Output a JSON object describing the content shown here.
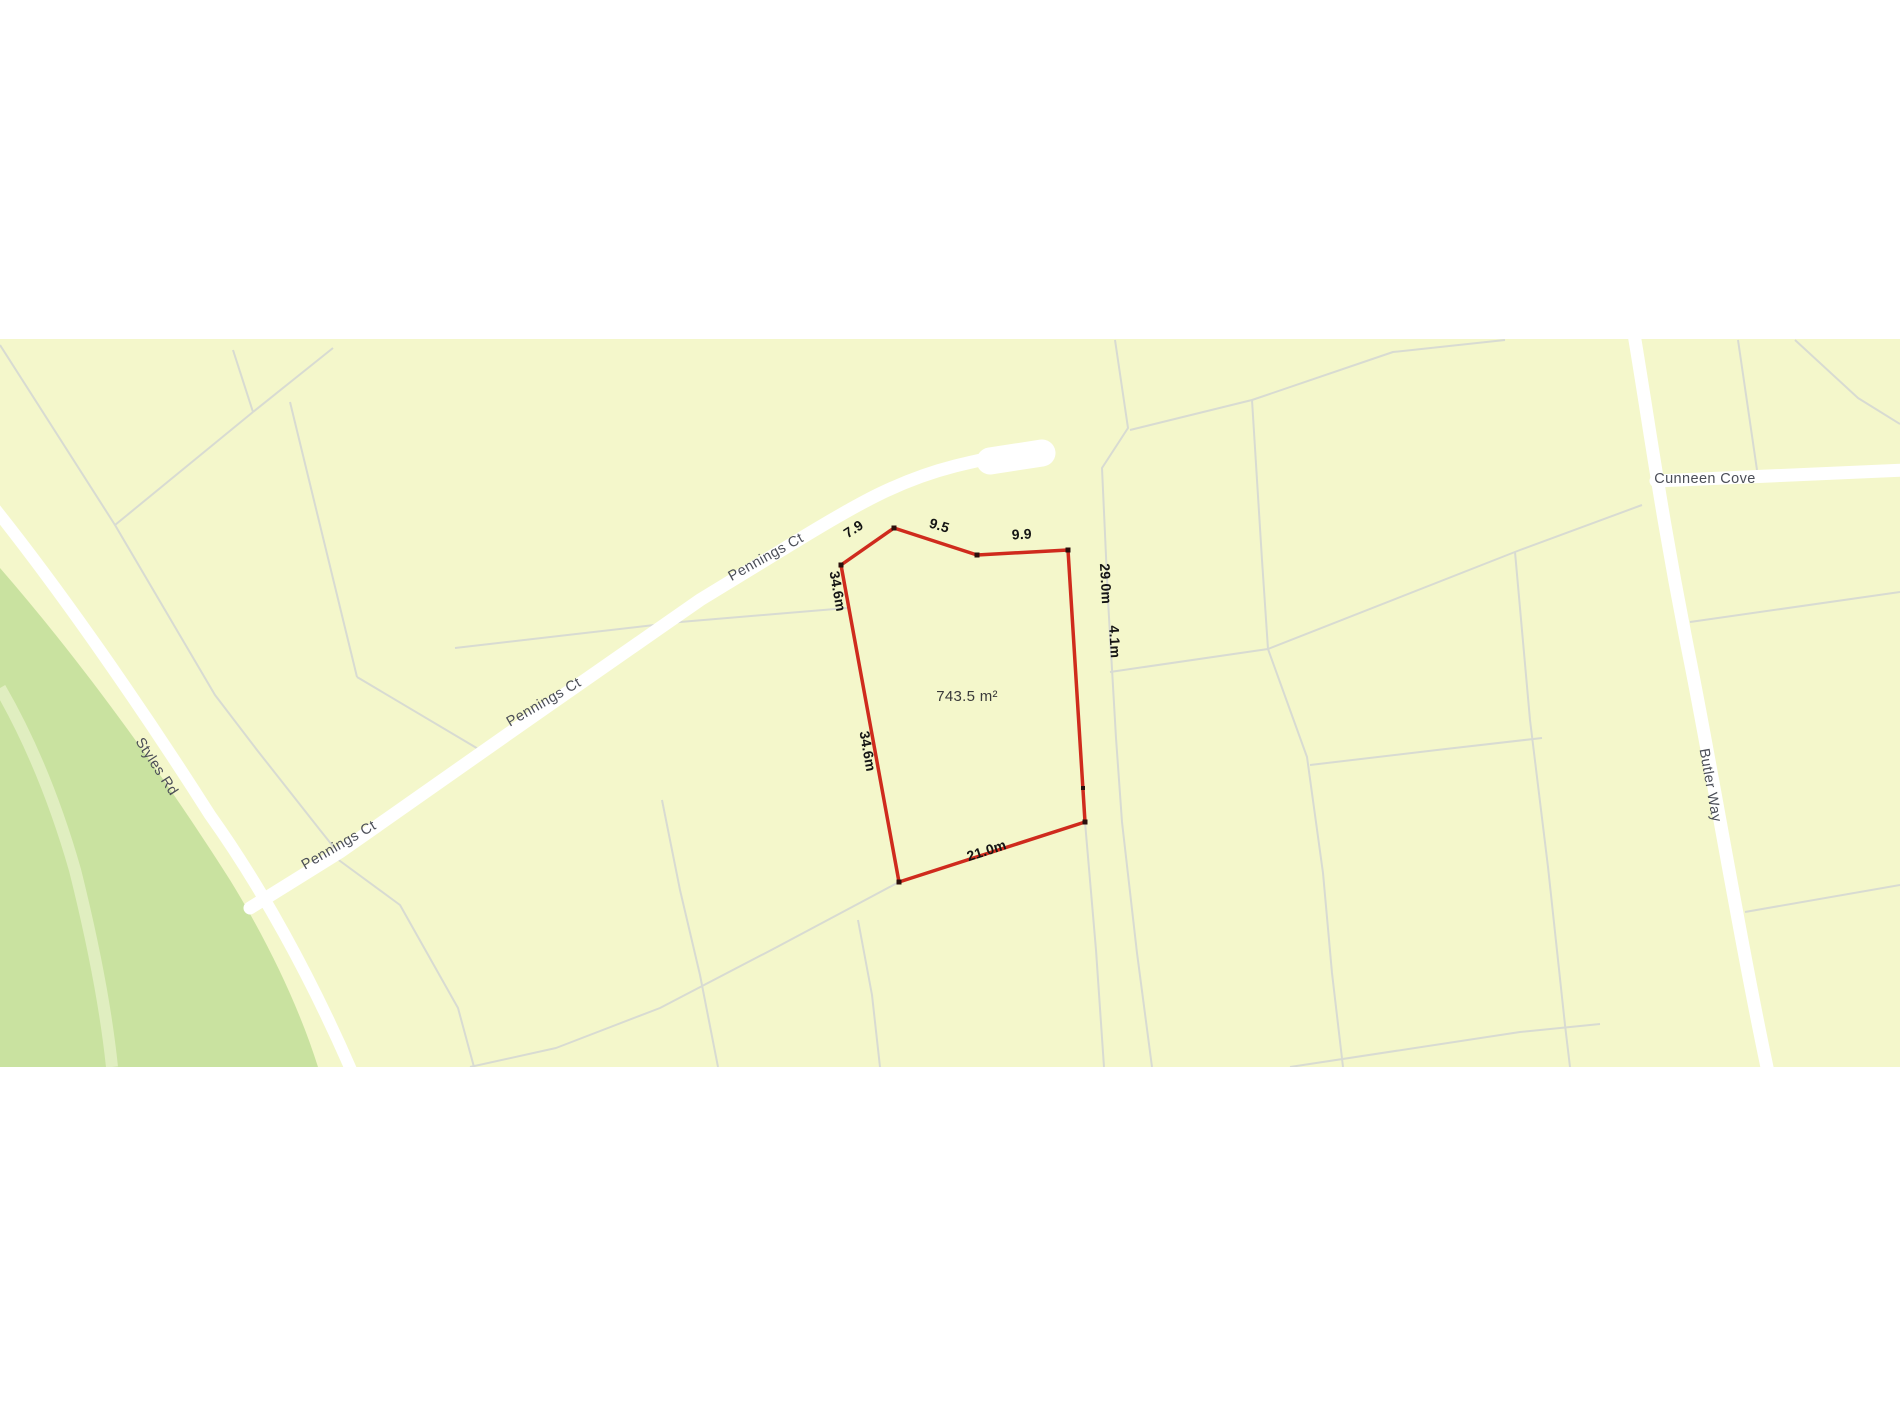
{
  "map": {
    "colors": {
      "background": "#ffffff",
      "parcel_fill": "#f4f7cb",
      "park_fill": "#c9e2a0",
      "park_path": "#e0eec0",
      "road_fill": "#ffffff",
      "boundary_line": "#d8dbd2",
      "lot_outline": "#cf2b1d",
      "vertex_marker": "#2b0f0c",
      "dimension_text": "#141414",
      "road_text": "#4b4e57"
    },
    "roads": {
      "pennings": "Pennings Ct",
      "styles": "Styles Rd",
      "cunneen": "Cunneen Cove",
      "butler": "Butler Way"
    },
    "parcel": {
      "area_label": "743.5 m²",
      "dimensions": {
        "top_left": "7.9",
        "top_mid": "9.5",
        "top_right": "9.9",
        "left": "34.6m",
        "right_upper": "29.0m",
        "right_lower": "4.1m",
        "bottom": "21.0m"
      }
    }
  }
}
